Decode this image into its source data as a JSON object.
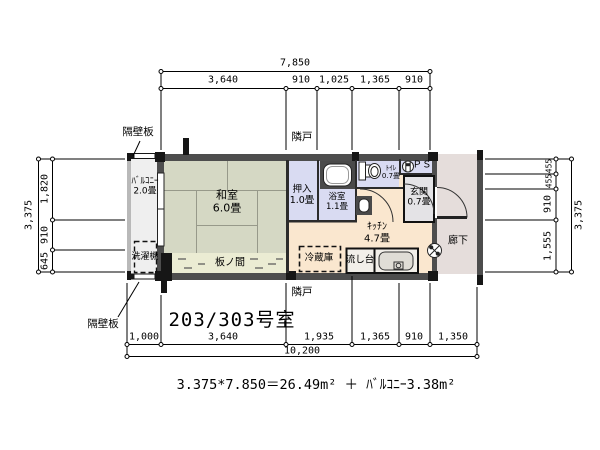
{
  "title": "203/303号室",
  "formula": "3.375*7.850＝26.49m² ＋ ﾊﾞﾙｺﾆｰ3.38m²",
  "dims": {
    "top": {
      "total": "7,850",
      "segments": [
        "3,640",
        "910",
        "1,025",
        "1,365",
        "910"
      ]
    },
    "bottom": {
      "total": "10,200",
      "segments": [
        "1,000",
        "3,640",
        "1,935",
        "1,365",
        "910",
        "1,350"
      ]
    },
    "left": {
      "total": "3,375",
      "segments": [
        "1,820",
        "910",
        "645"
      ]
    },
    "right": {
      "total": "3,375",
      "segments": [
        "455",
        "455",
        "910",
        "1,555"
      ]
    }
  },
  "rooms": {
    "balcony": {
      "name": "ﾊﾞﾙｺﾆｰ",
      "size": "2.0畳"
    },
    "washitsu": {
      "name": "和室",
      "size": "6.0畳"
    },
    "itanoma": {
      "name": "板ノ間"
    },
    "oshiire": {
      "name": "押入",
      "size": "1.0畳"
    },
    "bathroom": {
      "name": "浴室",
      "size": "1.1畳"
    },
    "toilet": {
      "name": "ﾄｲﾚ",
      "size": "0.7畳"
    },
    "pipe_space": {
      "name": "ＰＳ"
    },
    "genkan": {
      "name": "玄関",
      "size": "0.7畳"
    },
    "kitchen": {
      "name": "ｷｯﾁﾝ",
      "size": "4.7畳"
    },
    "corridor": {
      "name": "廊下"
    }
  },
  "fixtures": {
    "washing_machine": "洗濯機",
    "refrigerator": "冷蔵庫",
    "sink": "流し台"
  },
  "annotations": {
    "partition_board_top": "隔壁板",
    "partition_board_bottom": "隔壁板",
    "neighbor_top": "隣戸",
    "neighbor_bottom": "隣戸"
  },
  "colors": {
    "wall": "#4d4d4d",
    "wall_black": "#161616",
    "washitsu_fill": "#d5d8c4",
    "itanoma_fill": "#ebecd3",
    "service_fill": "#d9dbf2",
    "kitchen_fill": "#fae7cf",
    "genkan_fill": "#e4e3e6",
    "corridor_fill": "#e5dddb",
    "balcony_fill": "#efefef"
  }
}
